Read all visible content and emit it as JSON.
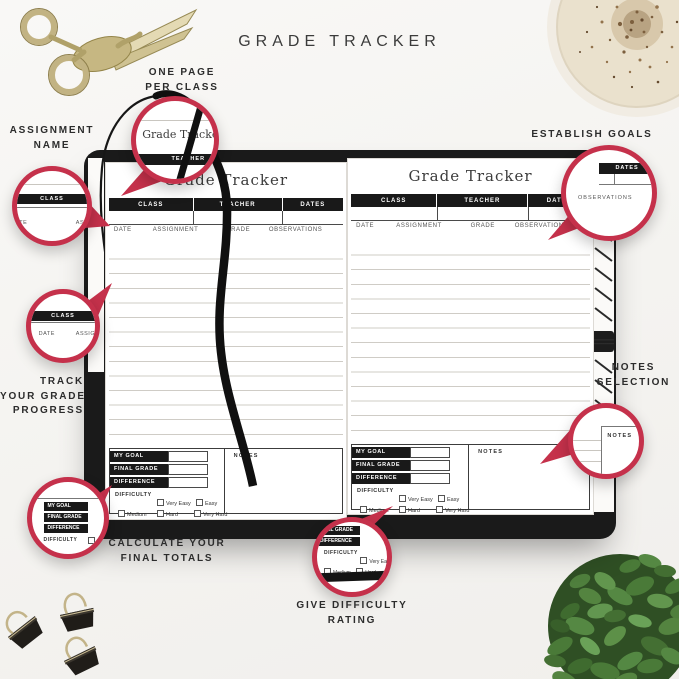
{
  "title": "GRADE TRACKER",
  "annotations": {
    "one_page_per_class": {
      "l1": "ONE PAGE",
      "l2": "PER CLASS"
    },
    "assignment_name": {
      "l1": "ASSIGNMENT",
      "l2": "NAME"
    },
    "establish_goals": {
      "l1": "ESTABLISH GOALS"
    },
    "track_progress": {
      "l1": "TRACK",
      "l2": "YOUR GRADE",
      "l3": "PROGRESS"
    },
    "notes_selection": {
      "l1": "NOTES",
      "l2": "SELECTION"
    },
    "calculate_totals": {
      "l1": "CALCULATE YOUR",
      "l2": "FINAL TOTALS"
    },
    "give_difficulty": {
      "l1": "GIVE DIFFICULTY",
      "l2": "RATING"
    }
  },
  "page": {
    "title": "Grade Tracker",
    "header_columns": [
      "CLASS",
      "TEACHER",
      "DATES"
    ],
    "table_columns": [
      "DATE",
      "ASSIGNMENT",
      "GRADE",
      "OBSERVATIONS"
    ],
    "goal_rows": [
      "MY GOAL",
      "FINAL GRADE",
      "DIFFERENCE"
    ],
    "difficulty_label": "DIFFICULTY",
    "difficulty_row1": [
      "Very Easy",
      "Easy"
    ],
    "difficulty_row2": [
      "Medium",
      "Hard",
      "Very Hard"
    ],
    "notes_label": "NOTES"
  },
  "colors": {
    "accent_red": "#c5314b",
    "cover_black": "#1a1a1a",
    "ink_black": "#191919"
  }
}
